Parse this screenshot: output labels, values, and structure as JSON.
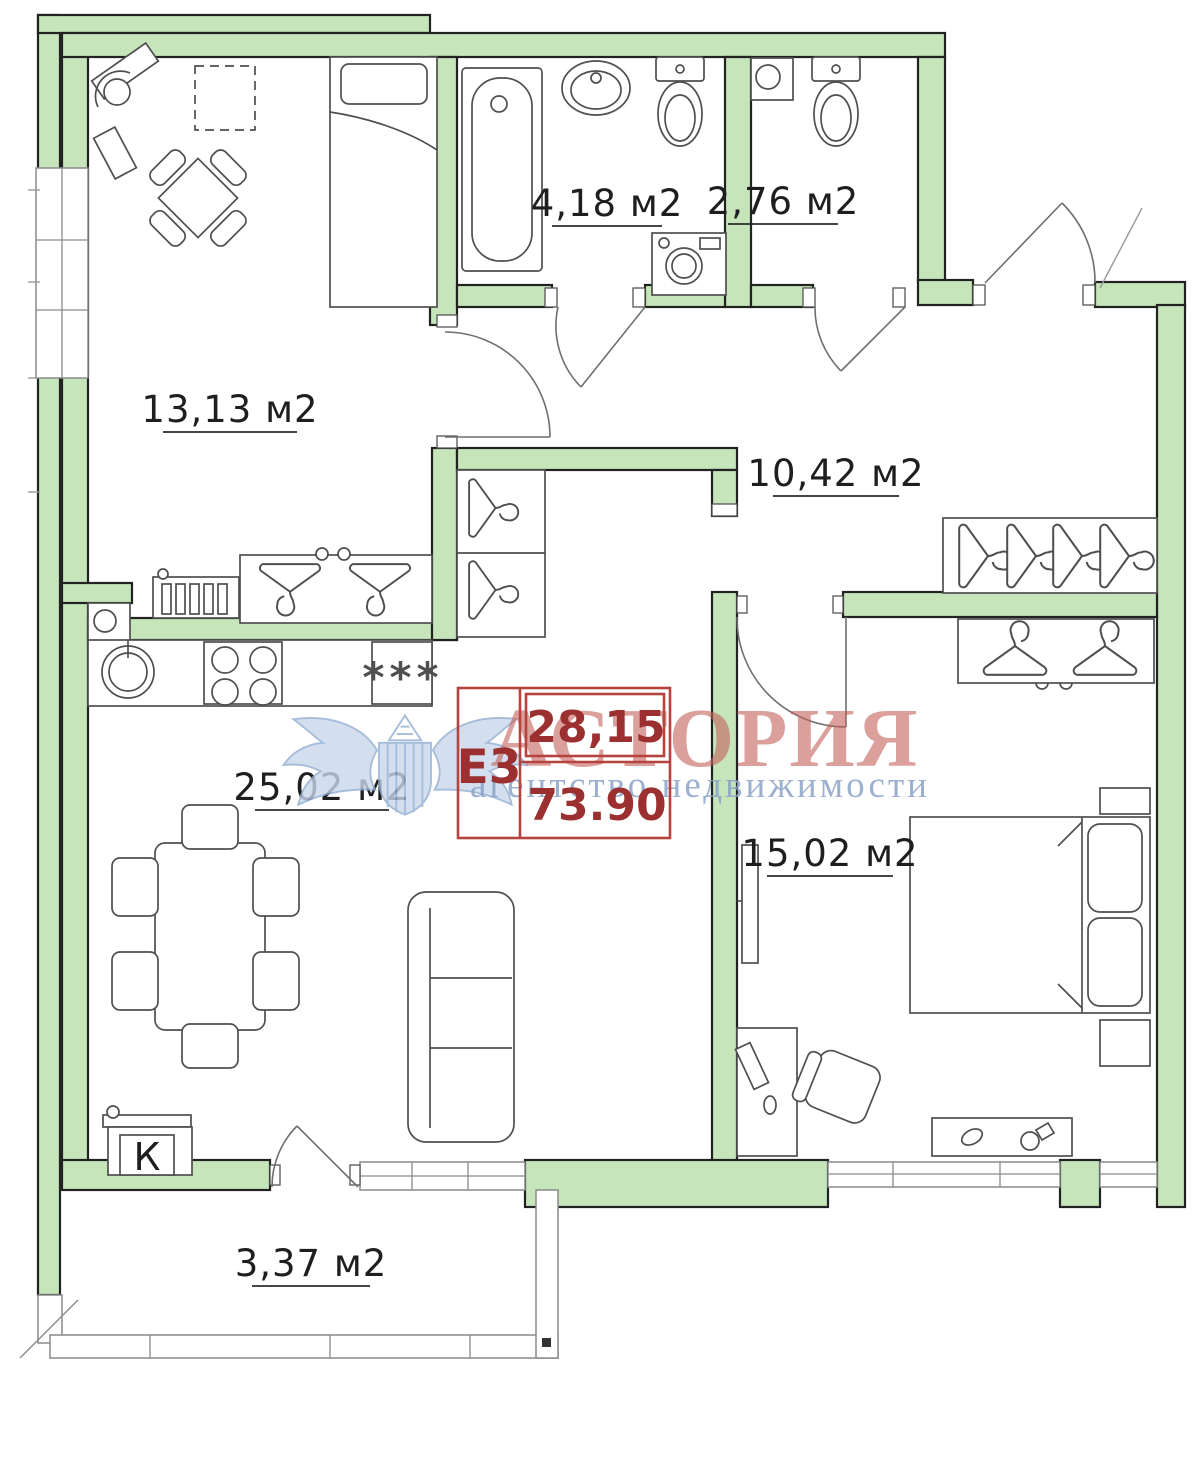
{
  "plan": {
    "rooms": {
      "room13": {
        "area_label": "13,13 м2"
      },
      "bathroom": {
        "area_label": "4,18 м2"
      },
      "wc": {
        "area_label": "2,76 м2"
      },
      "hall": {
        "area_label": "10,42 м2"
      },
      "kitchen_living": {
        "area_label": "25,02 м2"
      },
      "bedroom": {
        "area_label": "15,02 м2"
      },
      "balcony": {
        "area_label": "3,37 м2"
      }
    },
    "boiler_label": "К",
    "fridge_symbol": "***"
  },
  "type_box": {
    "unit_type": "Е3",
    "living_area": "28,15",
    "total_area": "73.90"
  },
  "watermark": {
    "brand": "АСТОРИЯ",
    "tagline": "агентство недвижимости"
  },
  "colors": {
    "wall_fill": "#c6e5bb",
    "wall_stroke": "#222222",
    "box_border_red": "#b5443f",
    "box_text_red": "#9c2f2f",
    "brand_pink": "#c4615c",
    "brand_blue": "#8ba3c7"
  }
}
